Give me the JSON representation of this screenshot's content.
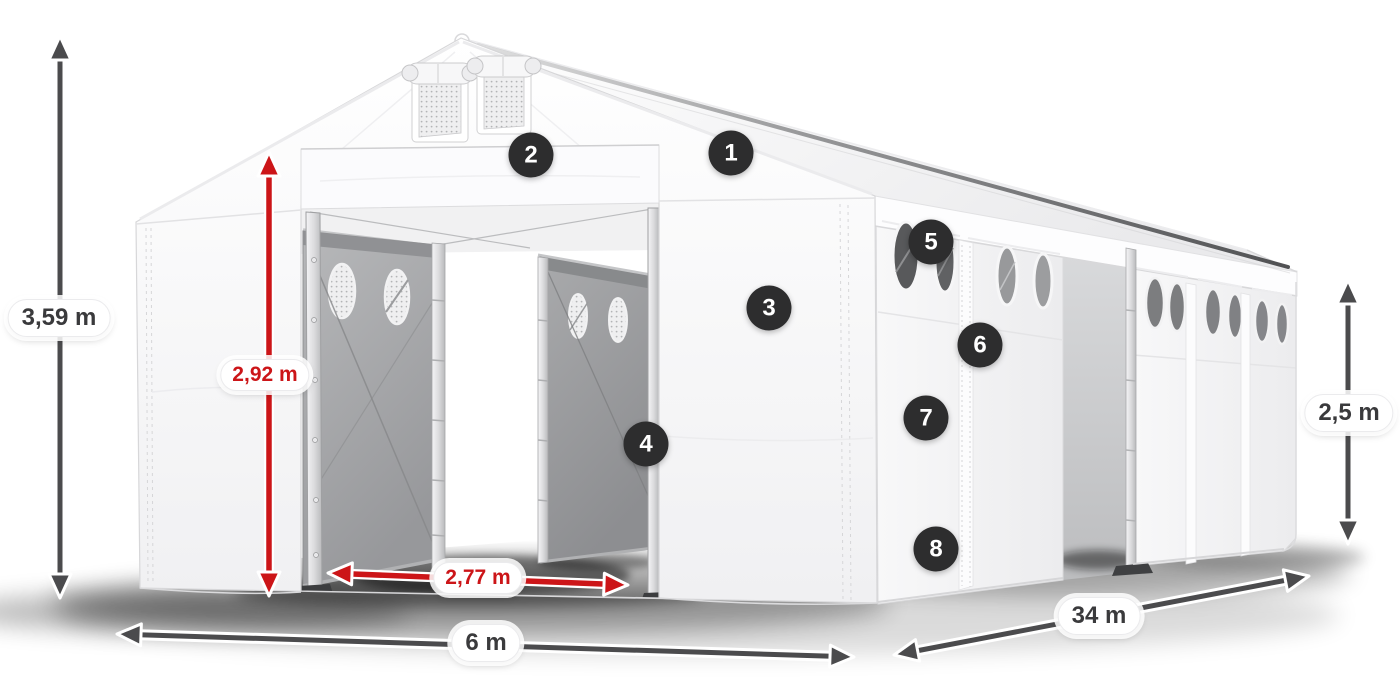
{
  "figure": {
    "type": "product-dimension-diagram",
    "subject": "White PVC storage marquee tent in 3D perspective with open front entrance doors and open side door",
    "measurements": {
      "total_height": "3,59 m",
      "entrance_height": "2,92 m",
      "entrance_width": "2,77 m",
      "front_width": "6 m",
      "side_length": "34 m",
      "side_wall_height": "2,5 m"
    },
    "callouts": [
      {
        "label": "1"
      },
      {
        "label": "2"
      },
      {
        "label": "3"
      },
      {
        "label": "4"
      },
      {
        "label": "5"
      },
      {
        "label": "6"
      },
      {
        "label": "7"
      },
      {
        "label": "8"
      }
    ],
    "colors": {
      "accent_red": "#cc1518",
      "arrow_gray": "#4b4b4d",
      "badge_background": "#2d2d2e",
      "badge_text": "#ffffff",
      "label_text_dark": "#3a3a3c",
      "label_background": "#ffffff",
      "tent_fabric": "#f4f4f6",
      "door_fabric_gray": "#a5a6a9",
      "ground_shadow": "#000000"
    }
  }
}
